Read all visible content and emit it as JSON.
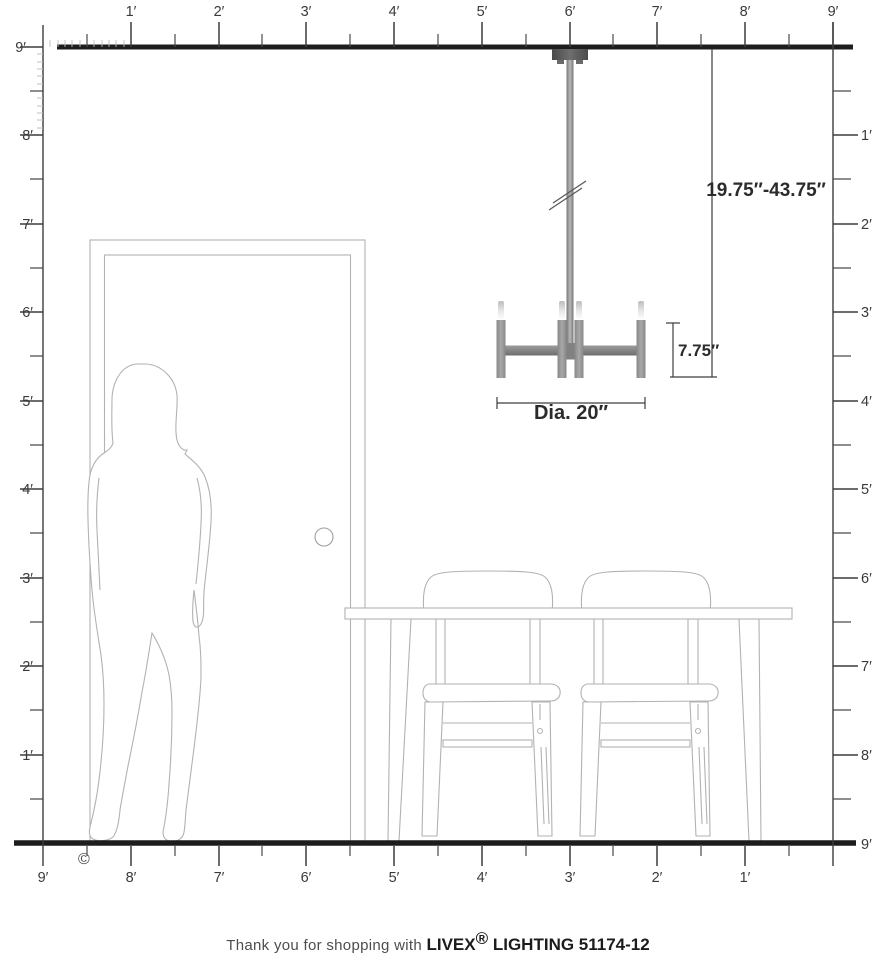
{
  "meta": {
    "copyright": "©"
  },
  "rulers": {
    "top": {
      "labels": [
        "1′",
        "2′",
        "3′",
        "4′",
        "5′",
        "6′",
        "7′",
        "8′",
        "9′"
      ]
    },
    "left": {
      "labels": [
        "9′",
        "8′",
        "7′",
        "6′",
        "5′",
        "4′",
        "3′",
        "2′",
        "1′"
      ]
    },
    "right": {
      "labels": [
        "1′",
        "2′",
        "3′",
        "4′",
        "5′",
        "6′",
        "7′",
        "8′",
        "9′"
      ]
    },
    "bottom": {
      "labels": [
        "9′",
        "8′",
        "7′",
        "6′",
        "5′",
        "4′",
        "3′",
        "2′",
        "1′"
      ]
    }
  },
  "dimensions": {
    "hang_range": "19.75″-43.75″",
    "fixture_height": "7.75″",
    "fixture_diameter": "Dia. 20″"
  },
  "footer": {
    "prefix": "Thank you for shopping with ",
    "brand": "LIVEX",
    "registered": "®",
    "suffix": " LIGHTING 51174-12"
  },
  "colors": {
    "structure_line": "#1d1d1d",
    "ruler_line": "#3d3d3d",
    "furniture_outline": "#b2b2b2",
    "fixture_gray": "#8c8c8c"
  }
}
